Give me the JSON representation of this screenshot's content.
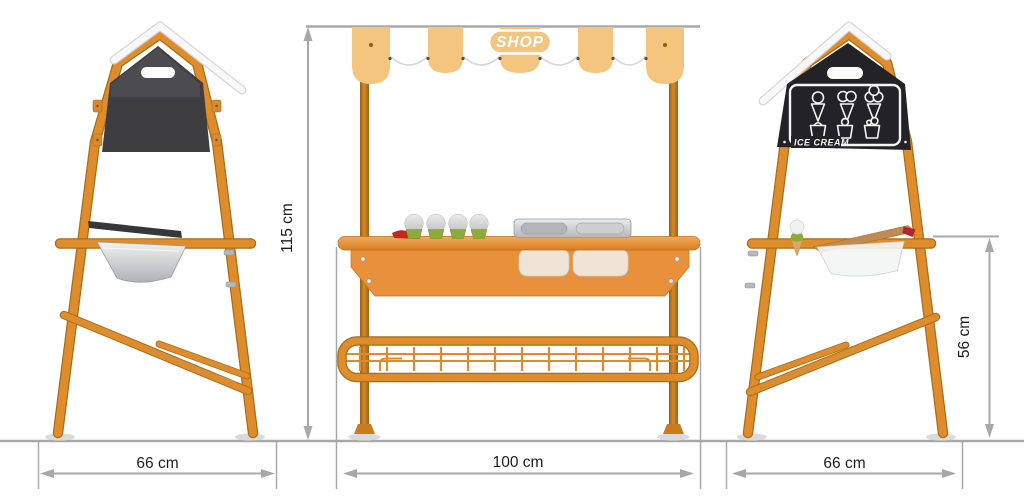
{
  "views": {
    "left_side": {
      "width_label": "66 cm"
    },
    "front": {
      "height_label": "115 cm",
      "width_label": "100 cm",
      "awning_sign": "SHOP"
    },
    "right_side": {
      "width_label": "66 cm",
      "counter_height_label": "56 cm",
      "chalkboard_title": "ICE CREAM"
    }
  },
  "measurements": {
    "overall_height_cm": 115,
    "front_width_cm": 100,
    "side_width_cm": 66,
    "counter_height_cm": 56
  },
  "chalkboard_icons": [
    "ice-cream-cone-1-scoop",
    "ice-cream-cone-2-scoops",
    "ice-cream-cone-3-scoops",
    "ice-cream-cup",
    "ice-cream-cup-with-scoop",
    "ice-cream-cup-with-tilted-scoop"
  ],
  "colors": {
    "frame_orange": "#df8d2c",
    "frame_orange_dark": "#a96d15",
    "awning_tan": "#f4c57e",
    "panel_dark": "#3e3e41",
    "chalkboard_black": "#232327",
    "dimension_gray": "#a8a8a8",
    "metal_gray": "#c9ccce",
    "cupcake_green": "#8cab39",
    "label_text": "#1c1c1c"
  }
}
